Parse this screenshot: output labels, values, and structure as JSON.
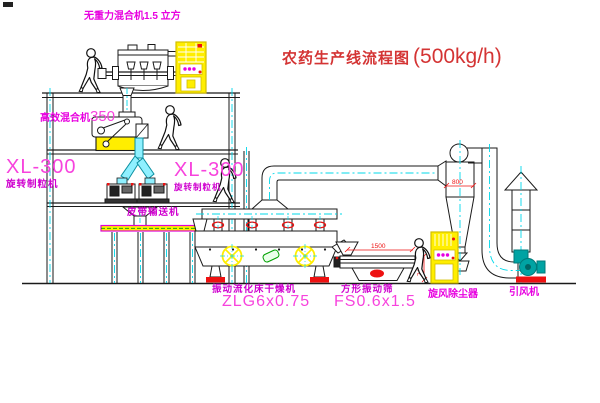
{
  "title": {
    "name": "农药生产线流程图",
    "capacity": "(500kg/h)"
  },
  "labels": {
    "gravity_free_mixer": "无重力混合机1.5 立方",
    "mixer_350": {
      "name": "高效混合机",
      "model": "350"
    },
    "granulator_left": {
      "model": "XL-300",
      "name": "旋转制粒机"
    },
    "granulator_right": {
      "model": "XL-300",
      "name": "旋转制粒机"
    },
    "belt_conveyor": "皮带输送机",
    "fluid_bed_dryer": {
      "name": "振动流化床干燥机",
      "model": "ZLG6x0.75"
    },
    "square_sieve": {
      "name": "方形振动筛",
      "model": "FS0.6x1.5"
    },
    "cyclone_collector": "旋风除尘器",
    "induced_draft_fan": "引风机"
  },
  "dimensions": {
    "cyclone_inlet": "800",
    "sieve_length": "1500",
    "sieve_height": "745"
  },
  "colors": {
    "line": "#1a1a1a",
    "pipe_cyan": "#00d8ea",
    "pipe_fill": "#8ff0ff",
    "equip_yellow": "#ffee00",
    "fan_teal": "#00a3a3",
    "dim_red": "#ee1111",
    "label_magenta": "#cf00cf",
    "model_magenta": "#f743dd",
    "title_red": "#d43434"
  }
}
